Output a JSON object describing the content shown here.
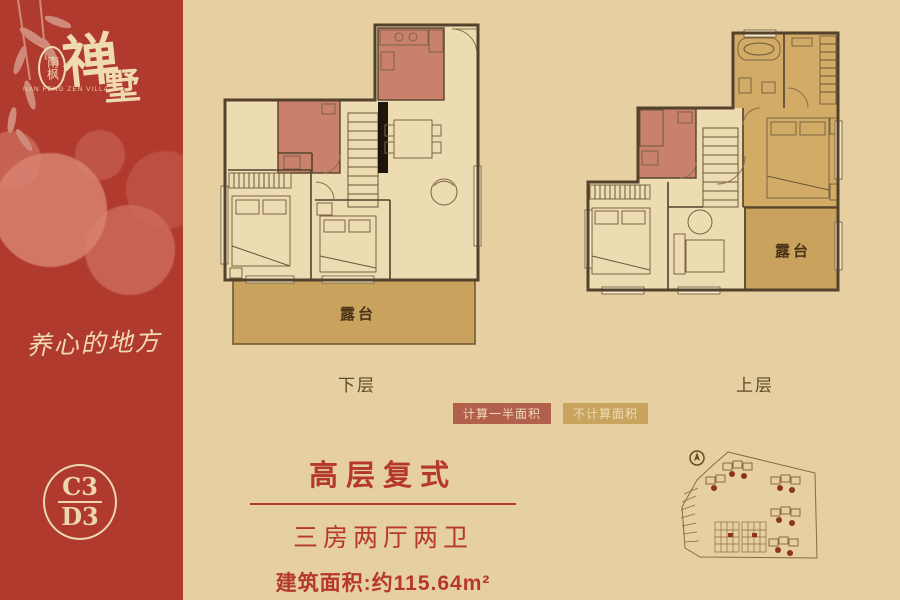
{
  "brand": {
    "seal": "南枫",
    "name_char1": "禅",
    "name_char2": "墅",
    "name_en": "NAN FENG ZEN VILLA",
    "slogan": "养心的地方",
    "unit_code_top": "C3",
    "unit_code_bottom": "D3"
  },
  "plans": {
    "lower": {
      "label": "下层",
      "terrace": "露台"
    },
    "upper": {
      "label": "上层",
      "terrace": "露台"
    }
  },
  "legend": {
    "half_area": {
      "label": "计算一半面积",
      "color": "#b2604c"
    },
    "no_area": {
      "label": "不计算面积",
      "color": "#c8a45f"
    }
  },
  "info": {
    "type": "高层复式",
    "rooms": "三房两厅两卫",
    "area": "建筑面积:约115.64m²"
  },
  "colors": {
    "sidebar_red": "#b13a2f",
    "background_tan": "#e6cfa0",
    "accent_text_red": "#b5382a",
    "plan_room_red": "#c9816c",
    "terrace_gold": "#c9a25e",
    "cream": "#f0dcb4",
    "wall_brown": "#54422c"
  }
}
